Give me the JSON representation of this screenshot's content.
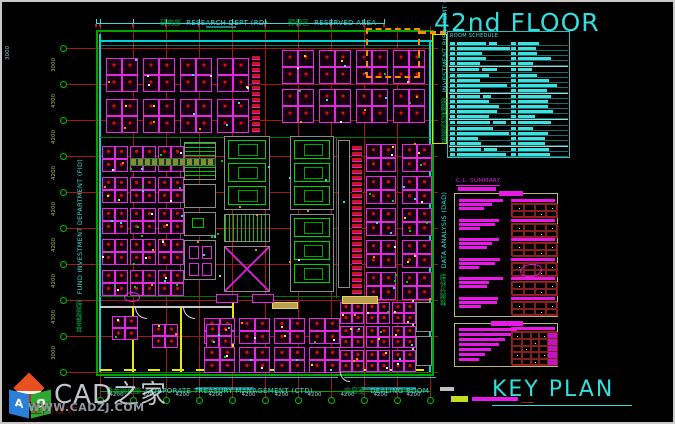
{
  "palette": {
    "cyan": "#35dede",
    "green": "#00a400",
    "bright_green": "#00d400",
    "magenta": "#e818e8",
    "desk_magenta": "#e02ae0",
    "red_grid": "#a51717",
    "red": "#d01212",
    "yellow": "#e8e800",
    "orange": "#ff8800",
    "khaki": "#b8b878",
    "gray_wall": "#8c8c8c",
    "legend_swatch": "#c6dc20",
    "watermark_gray": "#cfd6db",
    "url_gray": "#8f99a2"
  },
  "titles": {
    "floor_title": "42nd FLOOR",
    "key_plan": "KEY PLAN"
  },
  "schedule": {
    "title": "ROOM SCHEDULE",
    "row_count": 22
  },
  "summary": {
    "title": "C.L. SUMMARY",
    "group_count": 6
  },
  "plan": {
    "top_labels": [
      {
        "cn": "研究部",
        "en": "RESEARCH DEPT (RD)"
      },
      {
        "cn": "预留区",
        "en": "RESERVED AREA"
      }
    ],
    "bottom_labels": [
      {
        "cn": "资金管理部",
        "en": "CORPORATE TREASURY MANAGEMENT (CTD)"
      },
      {
        "cn": "交易室",
        "en": "DEALING ROOM"
      }
    ],
    "left_label": {
      "cn": "基金投资部",
      "en": "FUND INVESTMENT DEPARTMENT (FID)"
    },
    "right_labels": [
      {
        "cn": "投资风险管理部",
        "en": "INVESTMENT RISK MGMT (IRM)"
      },
      {
        "cn": "数据分析部",
        "en": "DATA ANALYSIS (DAD)"
      }
    ],
    "dims": {
      "far_left": "3000",
      "left": [
        "3000",
        "4300",
        "4200",
        "4200",
        "4200",
        "4200",
        "4200",
        "4300",
        "3000"
      ],
      "bottom": [
        "4200",
        "4200",
        "4200",
        "4200",
        "4200",
        "4200",
        "4200",
        "4200",
        "4200",
        "4200"
      ]
    }
  },
  "watermark": {
    "brand": "CAD之家",
    "url": "WWW.CADZJ.COM",
    "background_text": "室内设计",
    "cube_letters": [
      "A",
      "D"
    ]
  }
}
